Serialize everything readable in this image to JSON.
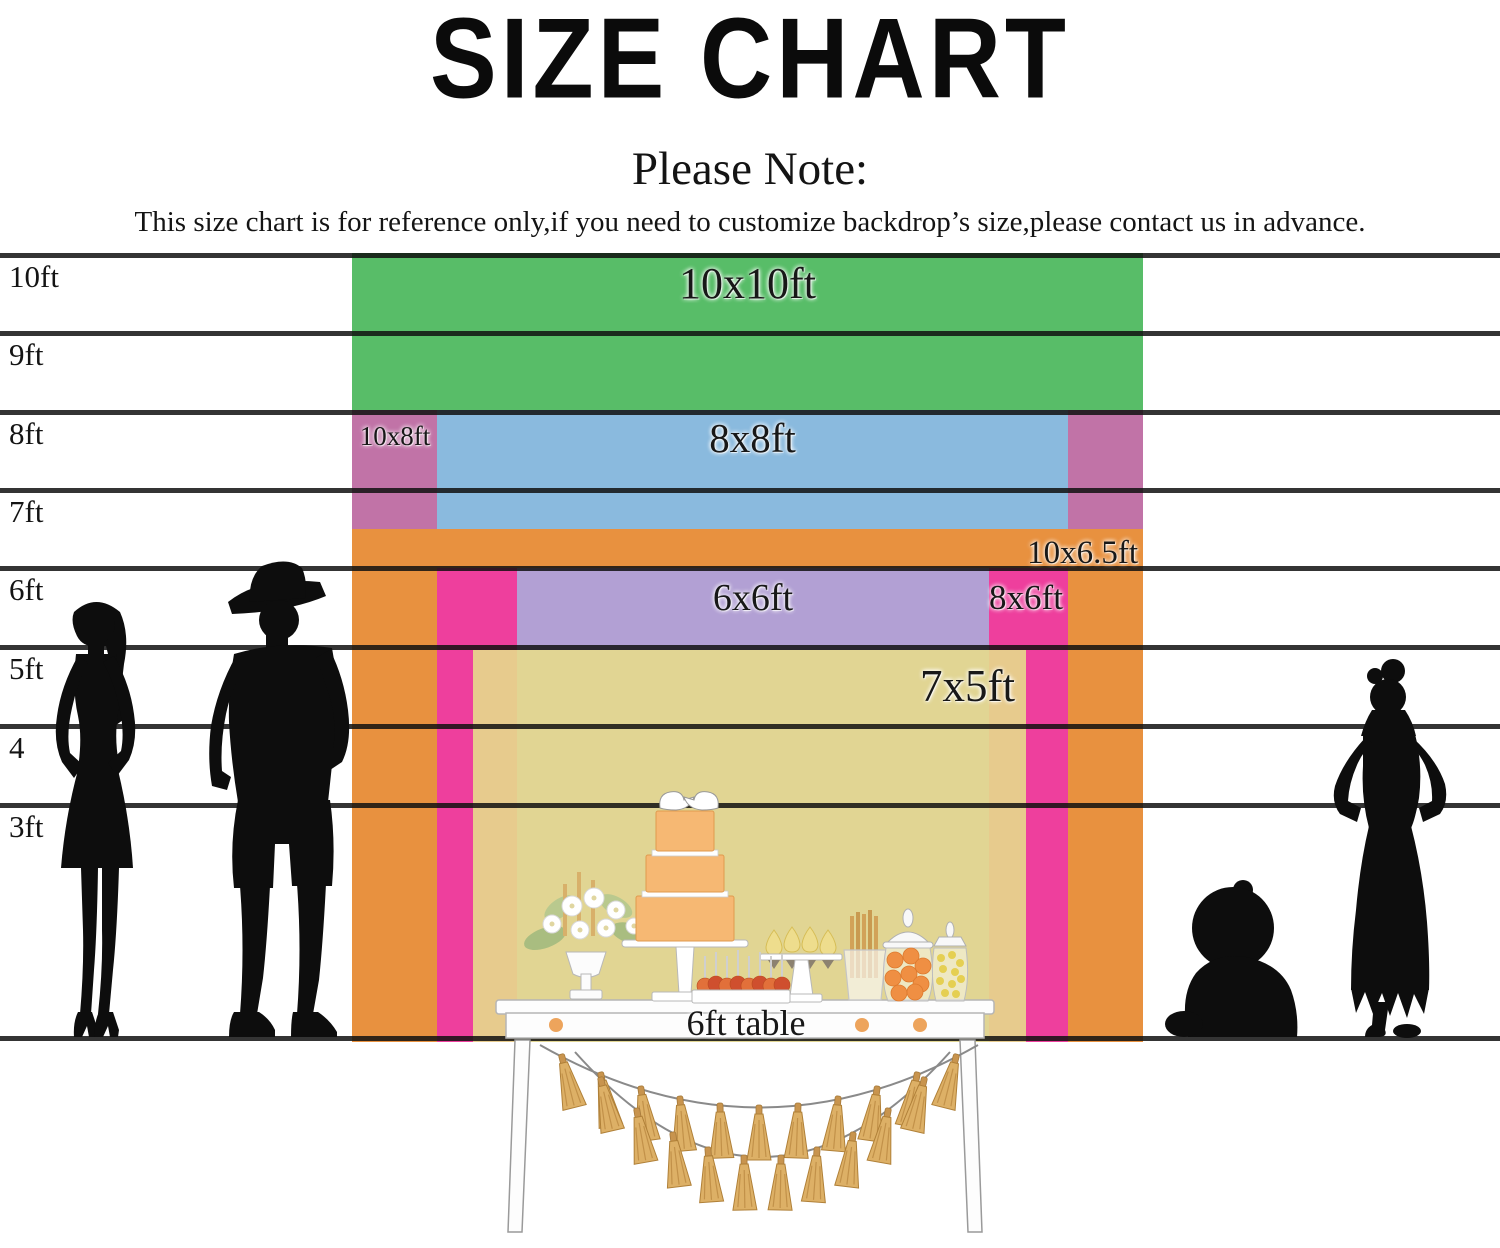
{
  "title": "SIZE CHART",
  "note": {
    "heading": "Please Note:",
    "body": "This size chart is for reference only,if you need to customize backdrop’s size,please contact us in advance."
  },
  "ruler": {
    "labels": [
      "10ft",
      "9ft",
      "8ft",
      "7ft",
      "6ft",
      "5ft",
      "4",
      "3ft"
    ]
  },
  "sizes": [
    {
      "label": "10x10ft",
      "color": "#58bd68"
    },
    {
      "label": "10x8ft",
      "color": "#c173a7"
    },
    {
      "label": "8x8ft",
      "color": "#8abade"
    },
    {
      "label": "10x6.5ft",
      "color": "#e8913f"
    },
    {
      "label": "6x6ft",
      "color": "#b2a0d4"
    },
    {
      "label": "8x6ft",
      "color": "#ee3f9d"
    },
    {
      "label": "7x5ft",
      "color": "rgba(230,218,140,0.9)"
    }
  ],
  "table": {
    "label": "6ft table"
  },
  "colors": {
    "silhouette": "#0d0d0d",
    "ruler_line": "rgba(17,17,17,0.85)",
    "tassel_gold": "#ddb066",
    "cake_orange": "#f6b873"
  }
}
